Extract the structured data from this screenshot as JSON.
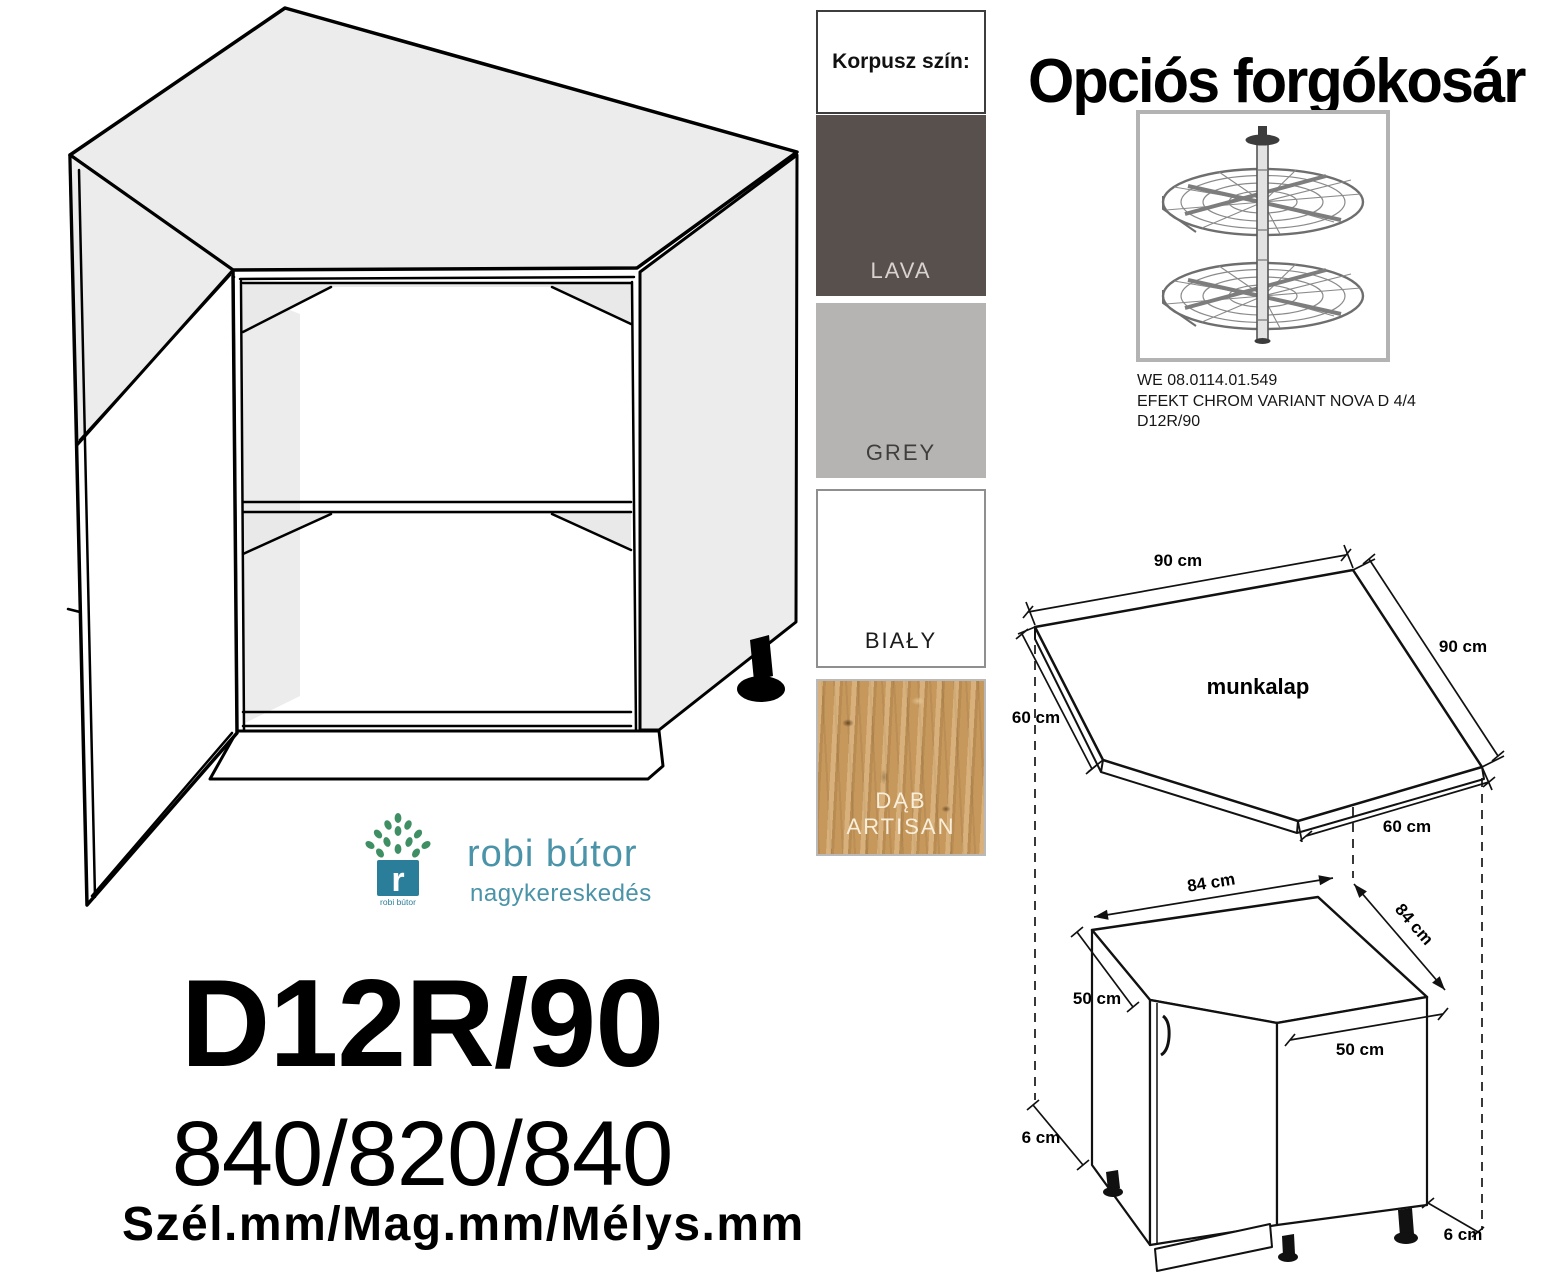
{
  "korpusz": {
    "header": "Korpusz szín:",
    "colors": [
      {
        "label": "LAVA",
        "hex": "#58504c",
        "text_color": "#d8d3ce",
        "border": ""
      },
      {
        "label": "GREY",
        "hex": "#b5b4b2",
        "text_color": "#3f3e3c",
        "border": ""
      },
      {
        "label": "BIAŁY",
        "hex": "#ffffff",
        "text_color": "#1c1c1c",
        "border": "#8f8f8f"
      },
      {
        "label": "DĄB ARTISAN",
        "hex": "#c6985c",
        "text_color": "#f8eed9",
        "border": "#b9b9b9"
      }
    ]
  },
  "basket": {
    "title": "Opciós forgókosár",
    "caption_lines": [
      "WE 08.0114.01.549",
      "EFEKT CHROM VARIANT NOVA D 4/4",
      "D12R/90"
    ]
  },
  "logo": {
    "brand": "robi bútor",
    "subtitle": "nagykereskedés",
    "icon_caption": "robi bútor",
    "teal": "#2b7e99",
    "leaf_green": "#3e8f63"
  },
  "product": {
    "code": "D12R/90",
    "size_line": "840/820/840",
    "units_line": "Szél.mm/Mag.mm/Mélys.mm"
  },
  "worktop_diagram": {
    "label": "munkalap",
    "dim_top": "90 cm",
    "dim_right": "90 cm",
    "dim_left": "60 cm",
    "dim_bottom": "60 cm"
  },
  "cabinet_diagram": {
    "dim_width": "84 cm",
    "dim_depth": "84 cm",
    "dim_left": "50 cm",
    "dim_front": "50 cm",
    "dim_plinth_left": "6 cm",
    "dim_plinth_right": "6 cm"
  }
}
